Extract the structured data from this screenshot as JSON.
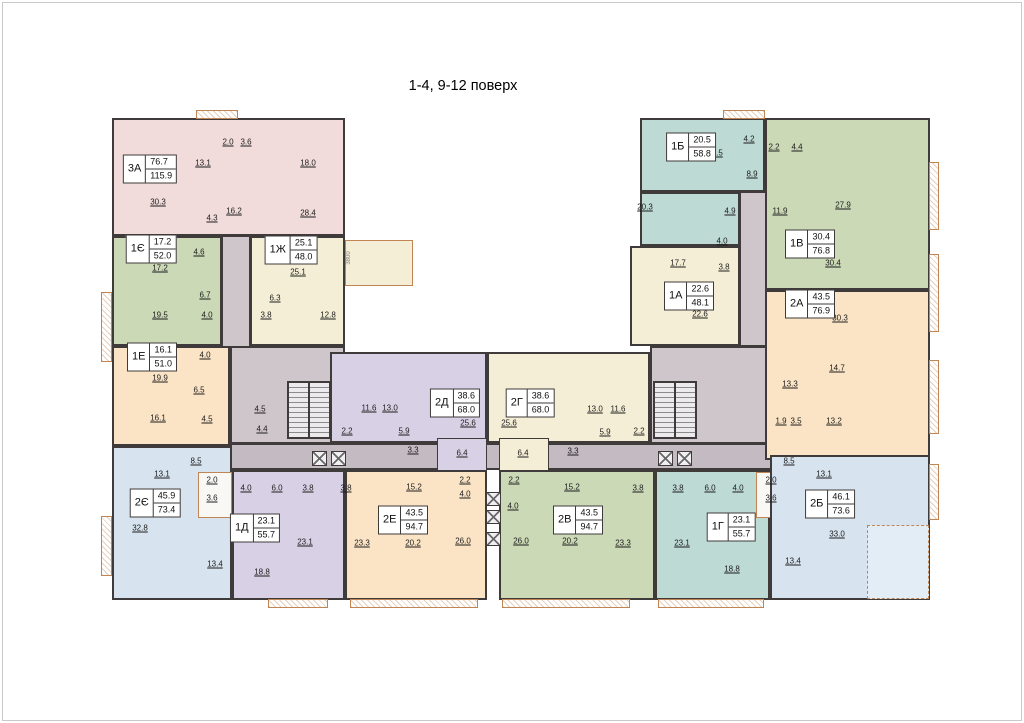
{
  "title": "1-4, 9-12 поверх",
  "colors": {
    "pink": "#f1dcdb",
    "green": "#ccd9b6",
    "cream": "#f5eed6",
    "peach": "#fbe4c5",
    "blue": "#d7e4ef",
    "purple": "#d8d1e5",
    "teal": "#bedad4",
    "corridor": "#cfc6cc",
    "corridor_dark": "#c4bac1",
    "pod": "#faf8f5",
    "loggia_blue": "#e3edf5",
    "wall": "#3f3b3a",
    "balcony": "#c08552"
  },
  "apartments": [
    {
      "code": "3А",
      "area_live": "76.7",
      "area_total": "115.9",
      "color": "pink",
      "label": {
        "x": 150,
        "y": 169
      },
      "rooms": [
        {
          "v": "2.0",
          "x": 228,
          "y": 142
        },
        {
          "v": "3.6",
          "x": 246,
          "y": 142
        },
        {
          "v": "13.1",
          "x": 203,
          "y": 163
        },
        {
          "v": "18.0",
          "x": 308,
          "y": 163
        },
        {
          "v": "30.3",
          "x": 158,
          "y": 202
        },
        {
          "v": "16.2",
          "x": 234,
          "y": 211
        },
        {
          "v": "4.3",
          "x": 212,
          "y": 218
        },
        {
          "v": "28.4",
          "x": 308,
          "y": 213
        }
      ]
    },
    {
      "code": "1Є",
      "area_live": "17.2",
      "area_total": "52.0",
      "color": "green",
      "label": {
        "x": 151,
        "y": 249
      },
      "rooms": [
        {
          "v": "4.6",
          "x": 199,
          "y": 252
        },
        {
          "v": "17.2",
          "x": 160,
          "y": 268
        },
        {
          "v": "6.7",
          "x": 205,
          "y": 295
        },
        {
          "v": "19.5",
          "x": 160,
          "y": 315
        },
        {
          "v": "4.0",
          "x": 207,
          "y": 315
        }
      ]
    },
    {
      "code": "1Ж",
      "area_live": "25.1",
      "area_total": "48.0",
      "color": "cream",
      "label": {
        "x": 291,
        "y": 250
      },
      "rooms": [
        {
          "v": "25.1",
          "x": 298,
          "y": 272
        },
        {
          "v": "6.3",
          "x": 275,
          "y": 298
        },
        {
          "v": "3.8",
          "x": 266,
          "y": 315
        },
        {
          "v": "12.8",
          "x": 328,
          "y": 315
        }
      ]
    },
    {
      "code": "1Е",
      "area_live": "16.1",
      "area_total": "51.0",
      "color": "peach",
      "label": {
        "x": 152,
        "y": 357
      },
      "rooms": [
        {
          "v": "4.0",
          "x": 205,
          "y": 355
        },
        {
          "v": "19.9",
          "x": 160,
          "y": 378
        },
        {
          "v": "6.5",
          "x": 199,
          "y": 390
        },
        {
          "v": "16.1",
          "x": 158,
          "y": 418
        },
        {
          "v": "4.5",
          "x": 207,
          "y": 419
        }
      ]
    },
    {
      "code": "2Є",
      "area_live": "45.9",
      "area_total": "73.4",
      "color": "blue",
      "label": {
        "x": 155,
        "y": 503
      },
      "rooms": [
        {
          "v": "8.5",
          "x": 196,
          "y": 461
        },
        {
          "v": "13.1",
          "x": 162,
          "y": 474
        },
        {
          "v": "2.0",
          "x": 212,
          "y": 480
        },
        {
          "v": "3.6",
          "x": 212,
          "y": 498
        },
        {
          "v": "32.8",
          "x": 140,
          "y": 528
        },
        {
          "v": "13.4",
          "x": 215,
          "y": 564
        }
      ]
    },
    {
      "code": "1Д",
      "area_live": "23.1",
      "area_total": "55.7",
      "color": "purple",
      "label": {
        "x": 255,
        "y": 528
      },
      "rooms": [
        {
          "v": "4.0",
          "x": 246,
          "y": 488
        },
        {
          "v": "6.0",
          "x": 277,
          "y": 488
        },
        {
          "v": "3.8",
          "x": 308,
          "y": 488
        },
        {
          "v": "23.1",
          "x": 305,
          "y": 542
        },
        {
          "v": "18.8",
          "x": 262,
          "y": 572
        }
      ]
    },
    {
      "code": "2Д",
      "area_live": "38.6",
      "area_total": "68.0",
      "color": "purple",
      "label": {
        "x": 455,
        "y": 403
      },
      "rooms": [
        {
          "v": "11.6",
          "x": 369,
          "y": 408
        },
        {
          "v": "13.0",
          "x": 390,
          "y": 408
        },
        {
          "v": "2.2",
          "x": 347,
          "y": 431
        },
        {
          "v": "5.9",
          "x": 404,
          "y": 431
        },
        {
          "v": "3.3",
          "x": 413,
          "y": 450
        },
        {
          "v": "25.6",
          "x": 468,
          "y": 423
        },
        {
          "v": "6.4",
          "x": 462,
          "y": 453
        }
      ]
    },
    {
      "code": "2Г",
      "area_live": "38.6",
      "area_total": "68.0",
      "color": "cream",
      "label": {
        "x": 530,
        "y": 403
      },
      "rooms": [
        {
          "v": "25.6",
          "x": 509,
          "y": 423
        },
        {
          "v": "6.4",
          "x": 523,
          "y": 453
        },
        {
          "v": "13.0",
          "x": 595,
          "y": 409
        },
        {
          "v": "11.6",
          "x": 618,
          "y": 409
        },
        {
          "v": "5.9",
          "x": 605,
          "y": 432
        },
        {
          "v": "2.2",
          "x": 639,
          "y": 431
        },
        {
          "v": "3.3",
          "x": 573,
          "y": 451
        }
      ]
    },
    {
      "code": "2Е",
      "area_live": "43.5",
      "area_total": "94.7",
      "color": "peach",
      "label": {
        "x": 403,
        "y": 520
      },
      "rooms": [
        {
          "v": "3.8",
          "x": 346,
          "y": 488
        },
        {
          "v": "15.2",
          "x": 414,
          "y": 487
        },
        {
          "v": "2.2",
          "x": 465,
          "y": 480
        },
        {
          "v": "4.0",
          "x": 465,
          "y": 494
        },
        {
          "v": "23.3",
          "x": 362,
          "y": 543
        },
        {
          "v": "20.2",
          "x": 413,
          "y": 543
        },
        {
          "v": "26.0",
          "x": 463,
          "y": 541
        }
      ]
    },
    {
      "code": "2В",
      "area_live": "43.5",
      "area_total": "94.7",
      "color": "green",
      "label": {
        "x": 578,
        "y": 520
      },
      "rooms": [
        {
          "v": "2.2",
          "x": 514,
          "y": 480
        },
        {
          "v": "4.0",
          "x": 513,
          "y": 506
        },
        {
          "v": "15.2",
          "x": 572,
          "y": 487
        },
        {
          "v": "3.8",
          "x": 638,
          "y": 488
        },
        {
          "v": "26.0",
          "x": 521,
          "y": 541
        },
        {
          "v": "20.2",
          "x": 570,
          "y": 541
        },
        {
          "v": "23.3",
          "x": 623,
          "y": 543
        }
      ]
    },
    {
      "code": "1Г",
      "area_live": "23.1",
      "area_total": "55.7",
      "color": "teal",
      "label": {
        "x": 731,
        "y": 527
      },
      "rooms": [
        {
          "v": "3.8",
          "x": 678,
          "y": 488
        },
        {
          "v": "6.0",
          "x": 710,
          "y": 488
        },
        {
          "v": "4.0",
          "x": 738,
          "y": 488
        },
        {
          "v": "23.1",
          "x": 682,
          "y": 543
        },
        {
          "v": "18.8",
          "x": 732,
          "y": 569
        }
      ]
    },
    {
      "code": "2Б",
      "area_live": "46.1",
      "area_total": "73.6",
      "color": "blue",
      "label": {
        "x": 830,
        "y": 504
      },
      "rooms": [
        {
          "v": "8.5",
          "x": 789,
          "y": 461
        },
        {
          "v": "13.1",
          "x": 824,
          "y": 474
        },
        {
          "v": "2.0",
          "x": 771,
          "y": 480
        },
        {
          "v": "3.6",
          "x": 771,
          "y": 498
        },
        {
          "v": "33.0",
          "x": 837,
          "y": 534
        },
        {
          "v": "13.4",
          "x": 793,
          "y": 561
        }
      ]
    },
    {
      "code": "1Б",
      "area_live": "20.5",
      "area_total": "58.8",
      "color": "teal",
      "label": {
        "x": 691,
        "y": 147
      },
      "rooms": [
        {
          "v": "4.2",
          "x": 749,
          "y": 139
        },
        {
          "v": "20.5",
          "x": 715,
          "y": 153
        },
        {
          "v": "8.9",
          "x": 752,
          "y": 174
        },
        {
          "v": "20.3",
          "x": 645,
          "y": 207
        },
        {
          "v": "4.9",
          "x": 730,
          "y": 211
        }
      ]
    },
    {
      "code": "1В",
      "area_live": "30.4",
      "area_total": "76.8",
      "color": "green",
      "label": {
        "x": 810,
        "y": 244
      },
      "rooms": [
        {
          "v": "2.2",
          "x": 774,
          "y": 147
        },
        {
          "v": "4.4",
          "x": 797,
          "y": 147
        },
        {
          "v": "27.9",
          "x": 843,
          "y": 205
        },
        {
          "v": "11.9",
          "x": 780,
          "y": 211
        },
        {
          "v": "30.4",
          "x": 833,
          "y": 263
        }
      ]
    },
    {
      "code": "1А",
      "area_live": "22.6",
      "area_total": "48.1",
      "color": "cream",
      "label": {
        "x": 689,
        "y": 296
      },
      "rooms": [
        {
          "v": "4.0",
          "x": 722,
          "y": 241
        },
        {
          "v": "17.7",
          "x": 678,
          "y": 263
        },
        {
          "v": "3.8",
          "x": 724,
          "y": 267
        },
        {
          "v": "22.6",
          "x": 700,
          "y": 314
        }
      ]
    },
    {
      "code": "2А",
      "area_live": "43.5",
      "area_total": "76.9",
      "color": "peach",
      "label": {
        "x": 810,
        "y": 304
      },
      "rooms": [
        {
          "v": "30.3",
          "x": 840,
          "y": 318
        },
        {
          "v": "14.7",
          "x": 837,
          "y": 368
        },
        {
          "v": "13.3",
          "x": 790,
          "y": 384
        },
        {
          "v": "1.9",
          "x": 781,
          "y": 421
        },
        {
          "v": "3.5",
          "x": 796,
          "y": 421
        },
        {
          "v": "13.2",
          "x": 834,
          "y": 421
        }
      ]
    }
  ],
  "common_labels": [
    {
      "v": "4.5",
      "x": 260,
      "y": 409
    },
    {
      "v": "4.4",
      "x": 262,
      "y": 429
    },
    {
      "v": "3800",
      "x": 349,
      "y": 258,
      "vert": true
    }
  ]
}
